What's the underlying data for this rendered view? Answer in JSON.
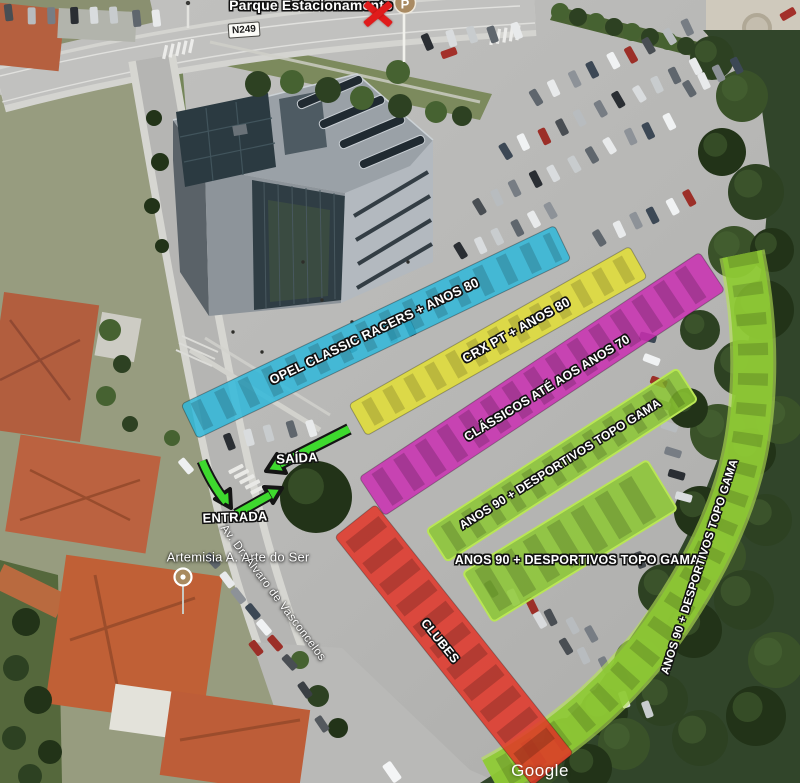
{
  "map": {
    "attribution": "Google",
    "road_shield": "N249",
    "parking_poi": {
      "label": "Parque Estacionamento",
      "marker_letter": "P"
    },
    "artemisia_poi": {
      "label": "Artemisia A. Arte do Ser"
    },
    "street_label": "Av. Dr. Álvaro de Vasconcelos",
    "flow": {
      "exit_label": "SAÍDA",
      "entrance_label": "ENTRADA",
      "arrow_color": "#3ed92e"
    },
    "zones": [
      {
        "name": "opel-classic-racers",
        "label": "OPEL CLASSIC RACERS + ANOS 80",
        "color": "#2db8da"
      },
      {
        "name": "crx-pt",
        "label": "CRX PT + ANOS 80",
        "color": "#e4e030"
      },
      {
        "name": "classicos-anos-70",
        "label": "CLÁSSICOS ATÉ AOS ANOS 70",
        "color": "#ca2fb2"
      },
      {
        "name": "anos90-row",
        "label": "ANOS 90 + DESPORTIVOS TOPO GAMA",
        "color": "#8cc832"
      },
      {
        "name": "anos90-block",
        "label": "ANOS 90 + DESPORTIVOS TOPO GAMA",
        "color": "#8cc832"
      },
      {
        "name": "anos90-edge",
        "label": "ANOS 90 + DESPORTIVOS TOPO GAMA",
        "color": "#8cc832"
      },
      {
        "name": "clubes",
        "label": "CLUBES",
        "color": "#e23326"
      }
    ]
  }
}
